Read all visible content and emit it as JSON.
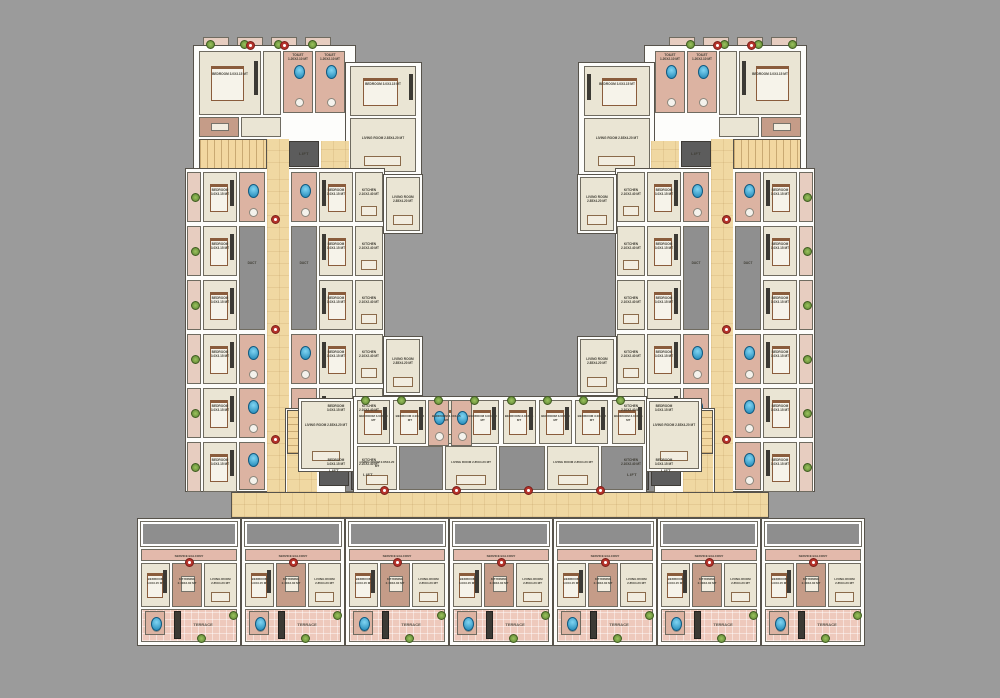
{
  "plan": {
    "type": "residential-floor-plan",
    "shape": "U-shaped apartment cluster, mirrored left/right wings, bottom terrace-unit row",
    "labels": {
      "bedroom": "BEDROOM 3.0X3.15 MT",
      "living_room": "LIVING ROOM 2.85X4.20 MT",
      "kitchen": "KITCHEN 2.10X2.40 MT",
      "kitchen_dining": "KIT/DINING 2.40X3.30 MT",
      "toilet": "TOILET 1.20X2.10 MT",
      "terrace": "TERRACE",
      "service_balcony": "SERVICE BALCONY",
      "lift": "LIFT",
      "duct": "DUCT"
    },
    "counts": {
      "bottom_row_units": 7,
      "wing_room_rows": 6,
      "inner_band_units": 8,
      "inner_band_plants": 8,
      "top_block_balconies": 4
    },
    "palette": {
      "background": "#9b9b9b",
      "corridor_yellow": "#f0d8a2",
      "room_cream": "#eae5d4",
      "terrace_pink": "#eec9bc",
      "kitchen_brown": "#c59c88",
      "duct_gray": "#8f8f8f",
      "shaft_gray": "#5c5c5c",
      "fixture_blue": "#2798c8",
      "plant_green": "#76a040",
      "marker_red": "#b5322a",
      "wall_white": "#ffffff"
    }
  }
}
